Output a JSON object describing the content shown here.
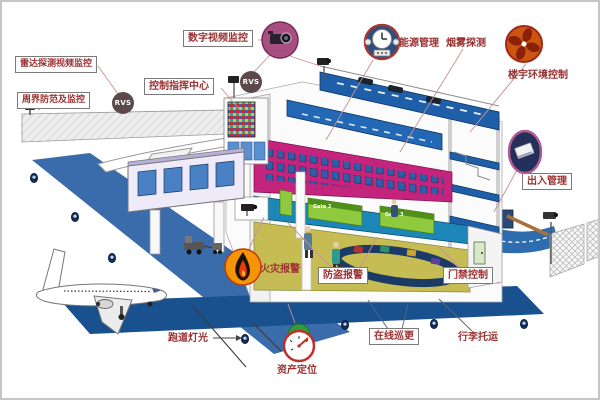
{
  "labels": {
    "digital_video": "数字视频监控",
    "radar_video": "雷达探测视频监控",
    "control_center": "控制指挥中心",
    "perimeter": "周界防范及监控",
    "energy": "能源管理",
    "smoke": "烟雾探测",
    "building_env": "楼宇环境控制",
    "access": "出入管理",
    "fire": "火灾报警",
    "burglar": "防盗报警",
    "door": "门禁控制",
    "patrol": "在线巡更",
    "baggage": "行李托运",
    "runway_light": "跑道灯光",
    "asset": "资产定位"
  },
  "badges": {
    "rvs": "RVS"
  },
  "gates": {
    "g2": "Gate 2",
    "g3": "Gate 3"
  },
  "colors": {
    "label_text": "#9b3232",
    "runway_blue": "#3a6cab",
    "taxiway_navy": "#19508e",
    "deck_blue": "#1f5ea9",
    "seating_magenta": "#c4247c",
    "gate_floor_teal": "#1c86b8",
    "gate_counter_green": "#8fca3e",
    "baggage_floor_olive": "#c5bd54",
    "rvs_badge": "#5c4a4a",
    "camera_icon_pink": "#a84f82",
    "fire_icon_orange": "#f59405",
    "fan_icon_orange": "#cc5512"
  }
}
